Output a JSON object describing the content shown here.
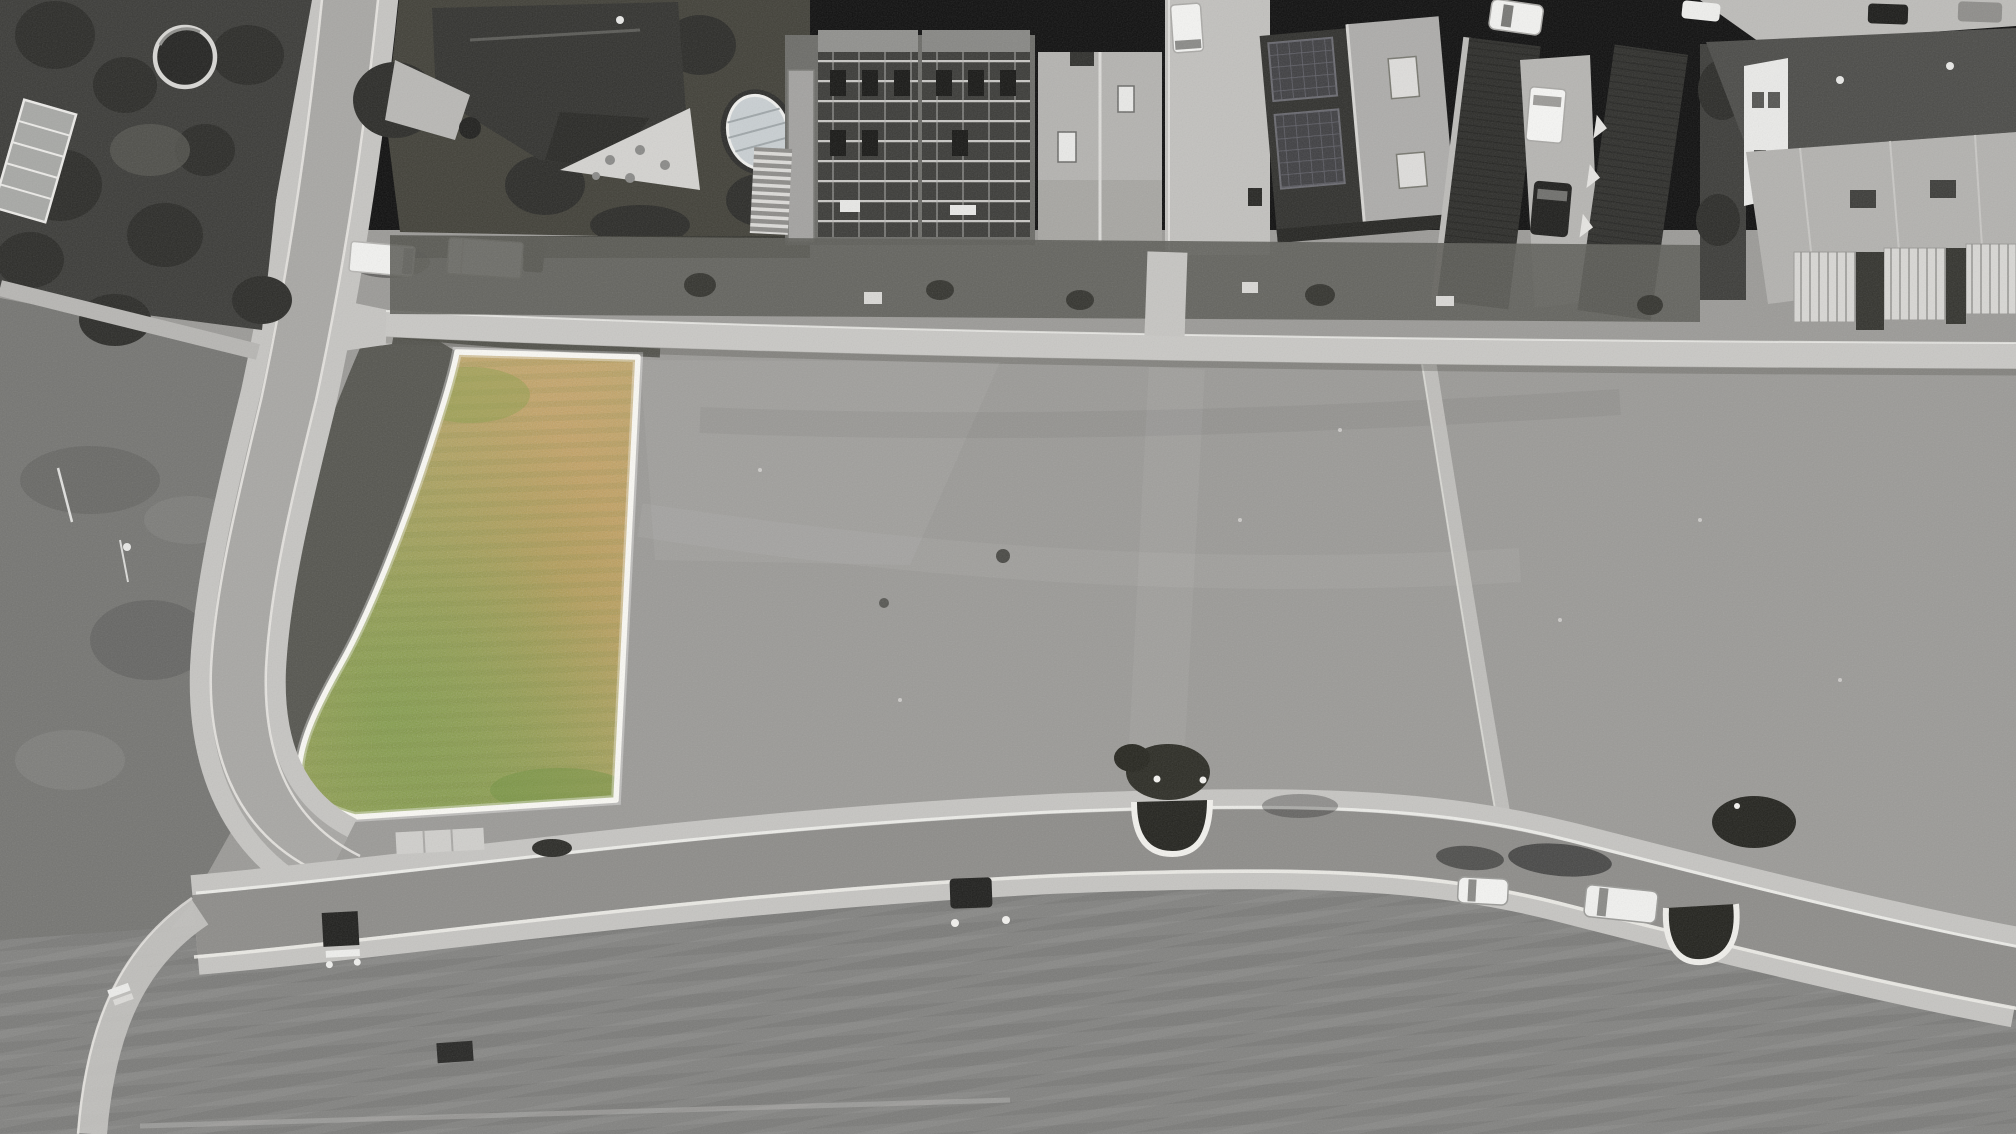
{
  "image": {
    "kind": "aerial drone photograph, top-down",
    "treatment": "black-and-white photo with a single building plot highlighted in color and outlined in white"
  },
  "colors": {
    "field": "#9b9a97",
    "bottom_field": "#828280",
    "gravel": "#757572",
    "verge_dark": "#55554f",
    "garden_dark": "#3b3b38",
    "tree_dark": "#2b2b28",
    "road_concrete": "#a8a7a4",
    "asphalt": "#8d8c89",
    "sidewalk": "#c6c5c2",
    "curb_white": "#efeeea",
    "roof_dark": "#32322f",
    "roof_light": "#b4b3b0",
    "building_white": "#eaeae8",
    "parcel_base": "#b2a45c",
    "parcel_green": "#7e9a41",
    "parcel_tan": "#c9a667",
    "parcel_orange": "#c59850",
    "parcel_outline": "#faf9f4",
    "vehicle_white": "#f3f3f1",
    "vehicle_dark": "#1d1d1b"
  },
  "parcel": {
    "label": "highlighted building plot",
    "shape": "elongated quadrilateral with rounded lower-left corner, white boundary line",
    "surface": "dry yellow-green meadow grass"
  },
  "scene_objects": {
    "roads": [
      "curving residential street from top edge to lower-left bend",
      "main street across lower third with planted traffic islands",
      "footpath along upper edge of the big meadow",
      "diagonal footpath crossing the right part of the meadow"
    ],
    "fields": [
      "large mowed grey meadow in the center",
      "mowed field below the main street",
      "rough graded ground left of the curving street"
    ],
    "buildings": [
      "detached house with garden pond, greenhouse and oval covered pool (top left/center)",
      "terraced houses under construction with scaffolding (top center)",
      "gable-roof house with skylights (top center-right)",
      "row houses with rooftop solar panels (top right)",
      "long row-house roofs with driveway between (top right)",
      "row houses with glass canopies (far top right)"
    ],
    "vehicles": [
      "two white box vans parked along the top street",
      "white car and white van on the main street",
      "white van and dark car in right driveway",
      "dark parked cars top right"
    ],
    "furniture": [
      "picnic bench below the main street",
      "white bench lower left",
      "dark bench lower center"
    ],
    "vegetation": [
      "dense dark trees upper left",
      "hedges along the gardens",
      "shrubs in the traffic islands"
    ]
  }
}
